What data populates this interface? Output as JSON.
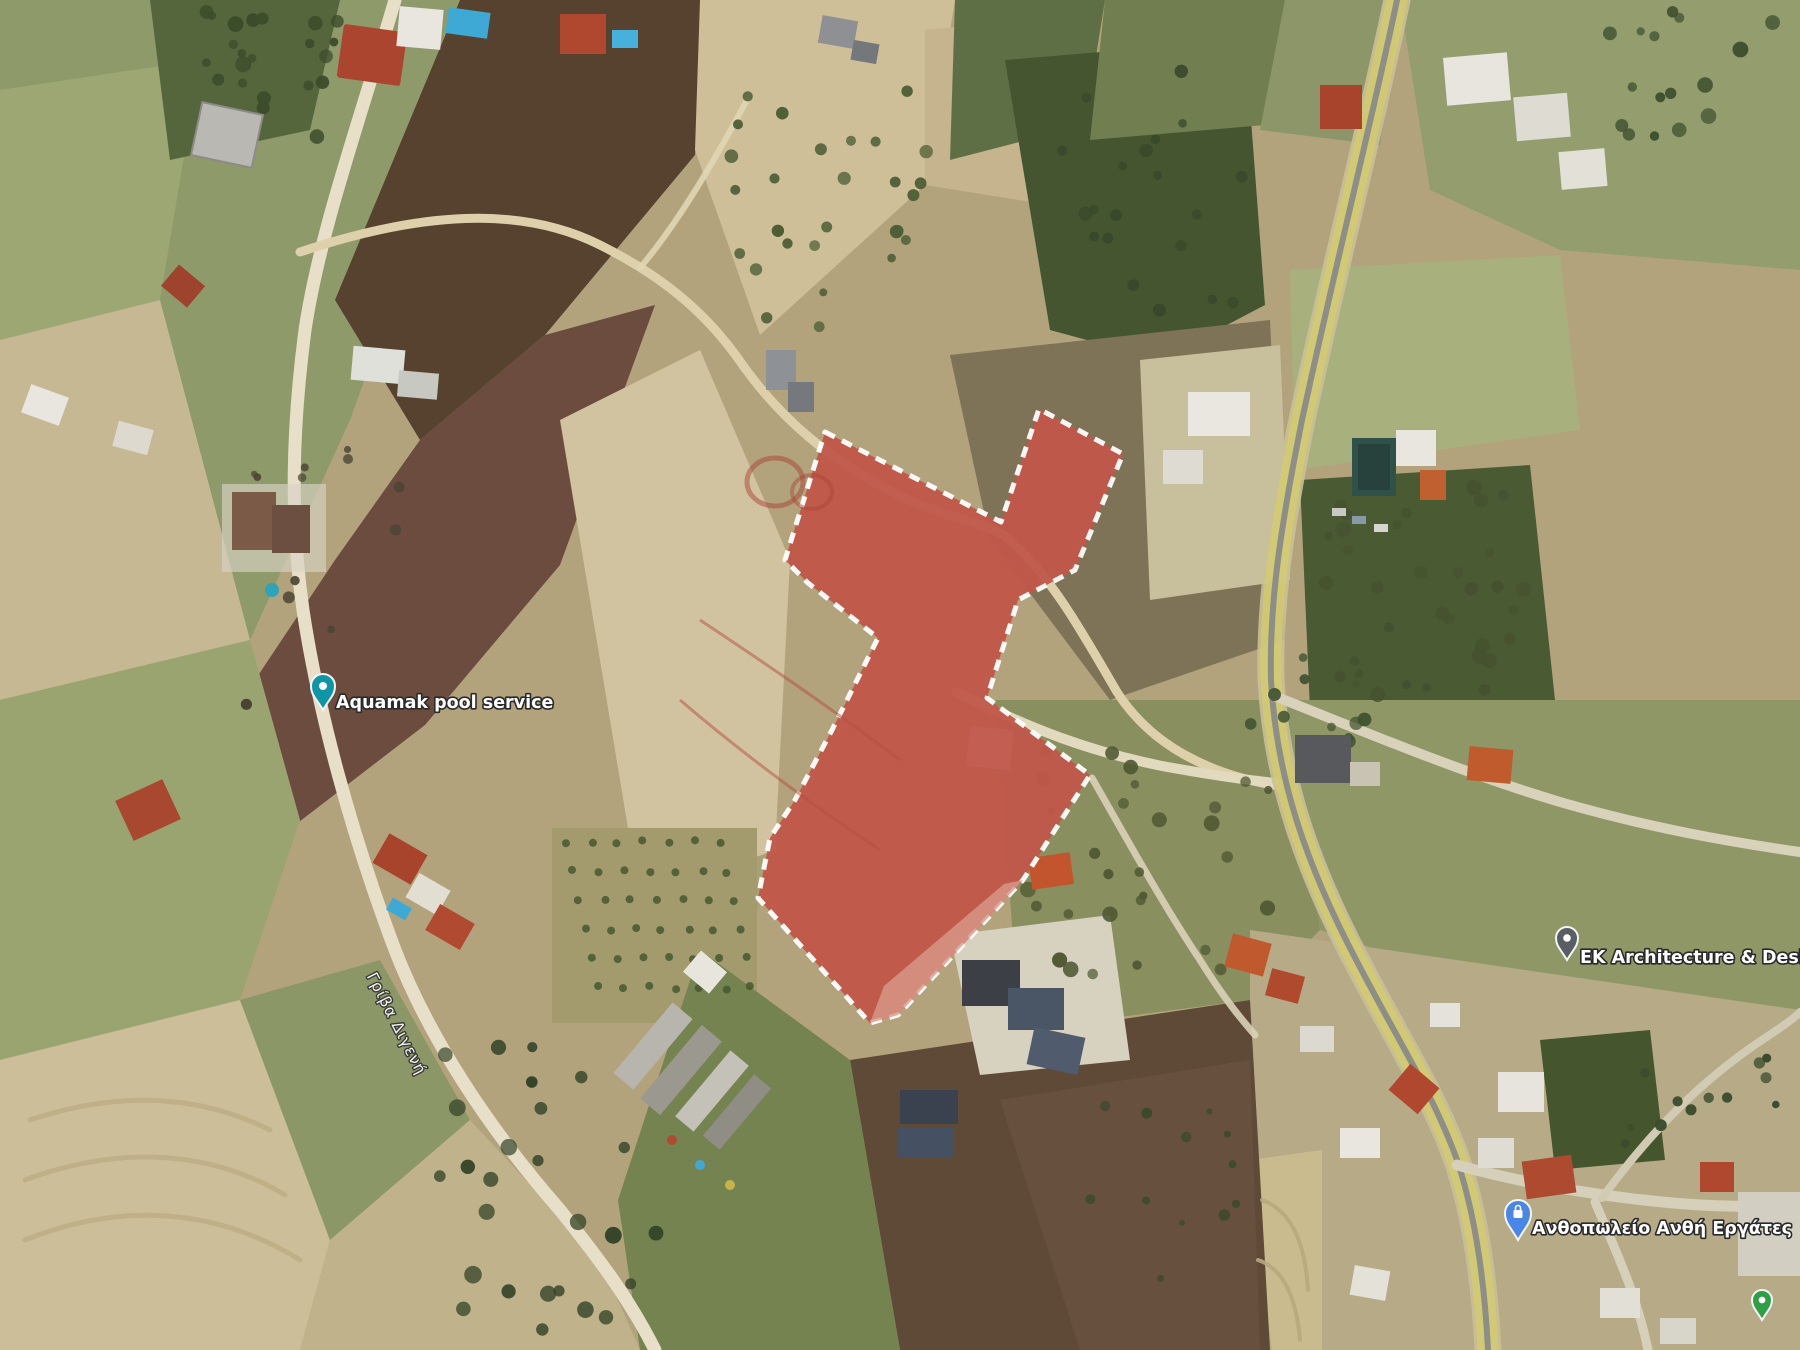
{
  "map_view": {
    "description": "Satellite aerial view of rural plots with a highlighted land parcel",
    "parcel": {
      "outline_points": "825,432 1001,522 1039,409 1123,454 1075,570 1018,600 987,698 1090,775 1023,880 898,1015 870,1023 758,898 770,838 795,800 832,730 878,638 808,583 785,560",
      "light_band_points": "1023,880 898,1015 870,1023 884,986 1004,884",
      "fill_color": "#c1574a",
      "light_band_color": "#d8998a",
      "border_color": "#ffffff"
    },
    "pois": [
      {
        "label": "Aquamak pool service",
        "pin_color": "#0e96a5"
      },
      {
        "label": "EK Architecture & Design",
        "pin_color": "#585e63"
      },
      {
        "label": "Ανθοπωλείο Ανθή Εργάτες",
        "pin_color": "#4a86e8"
      }
    ],
    "extra_pins": [
      {
        "pin_color": "#2e9e47"
      }
    ],
    "road_labels": [
      {
        "text": "Γρίβα Διγενή",
        "rotation_deg": 63
      }
    ],
    "highlighted_road_color": "#d9d05e"
  }
}
